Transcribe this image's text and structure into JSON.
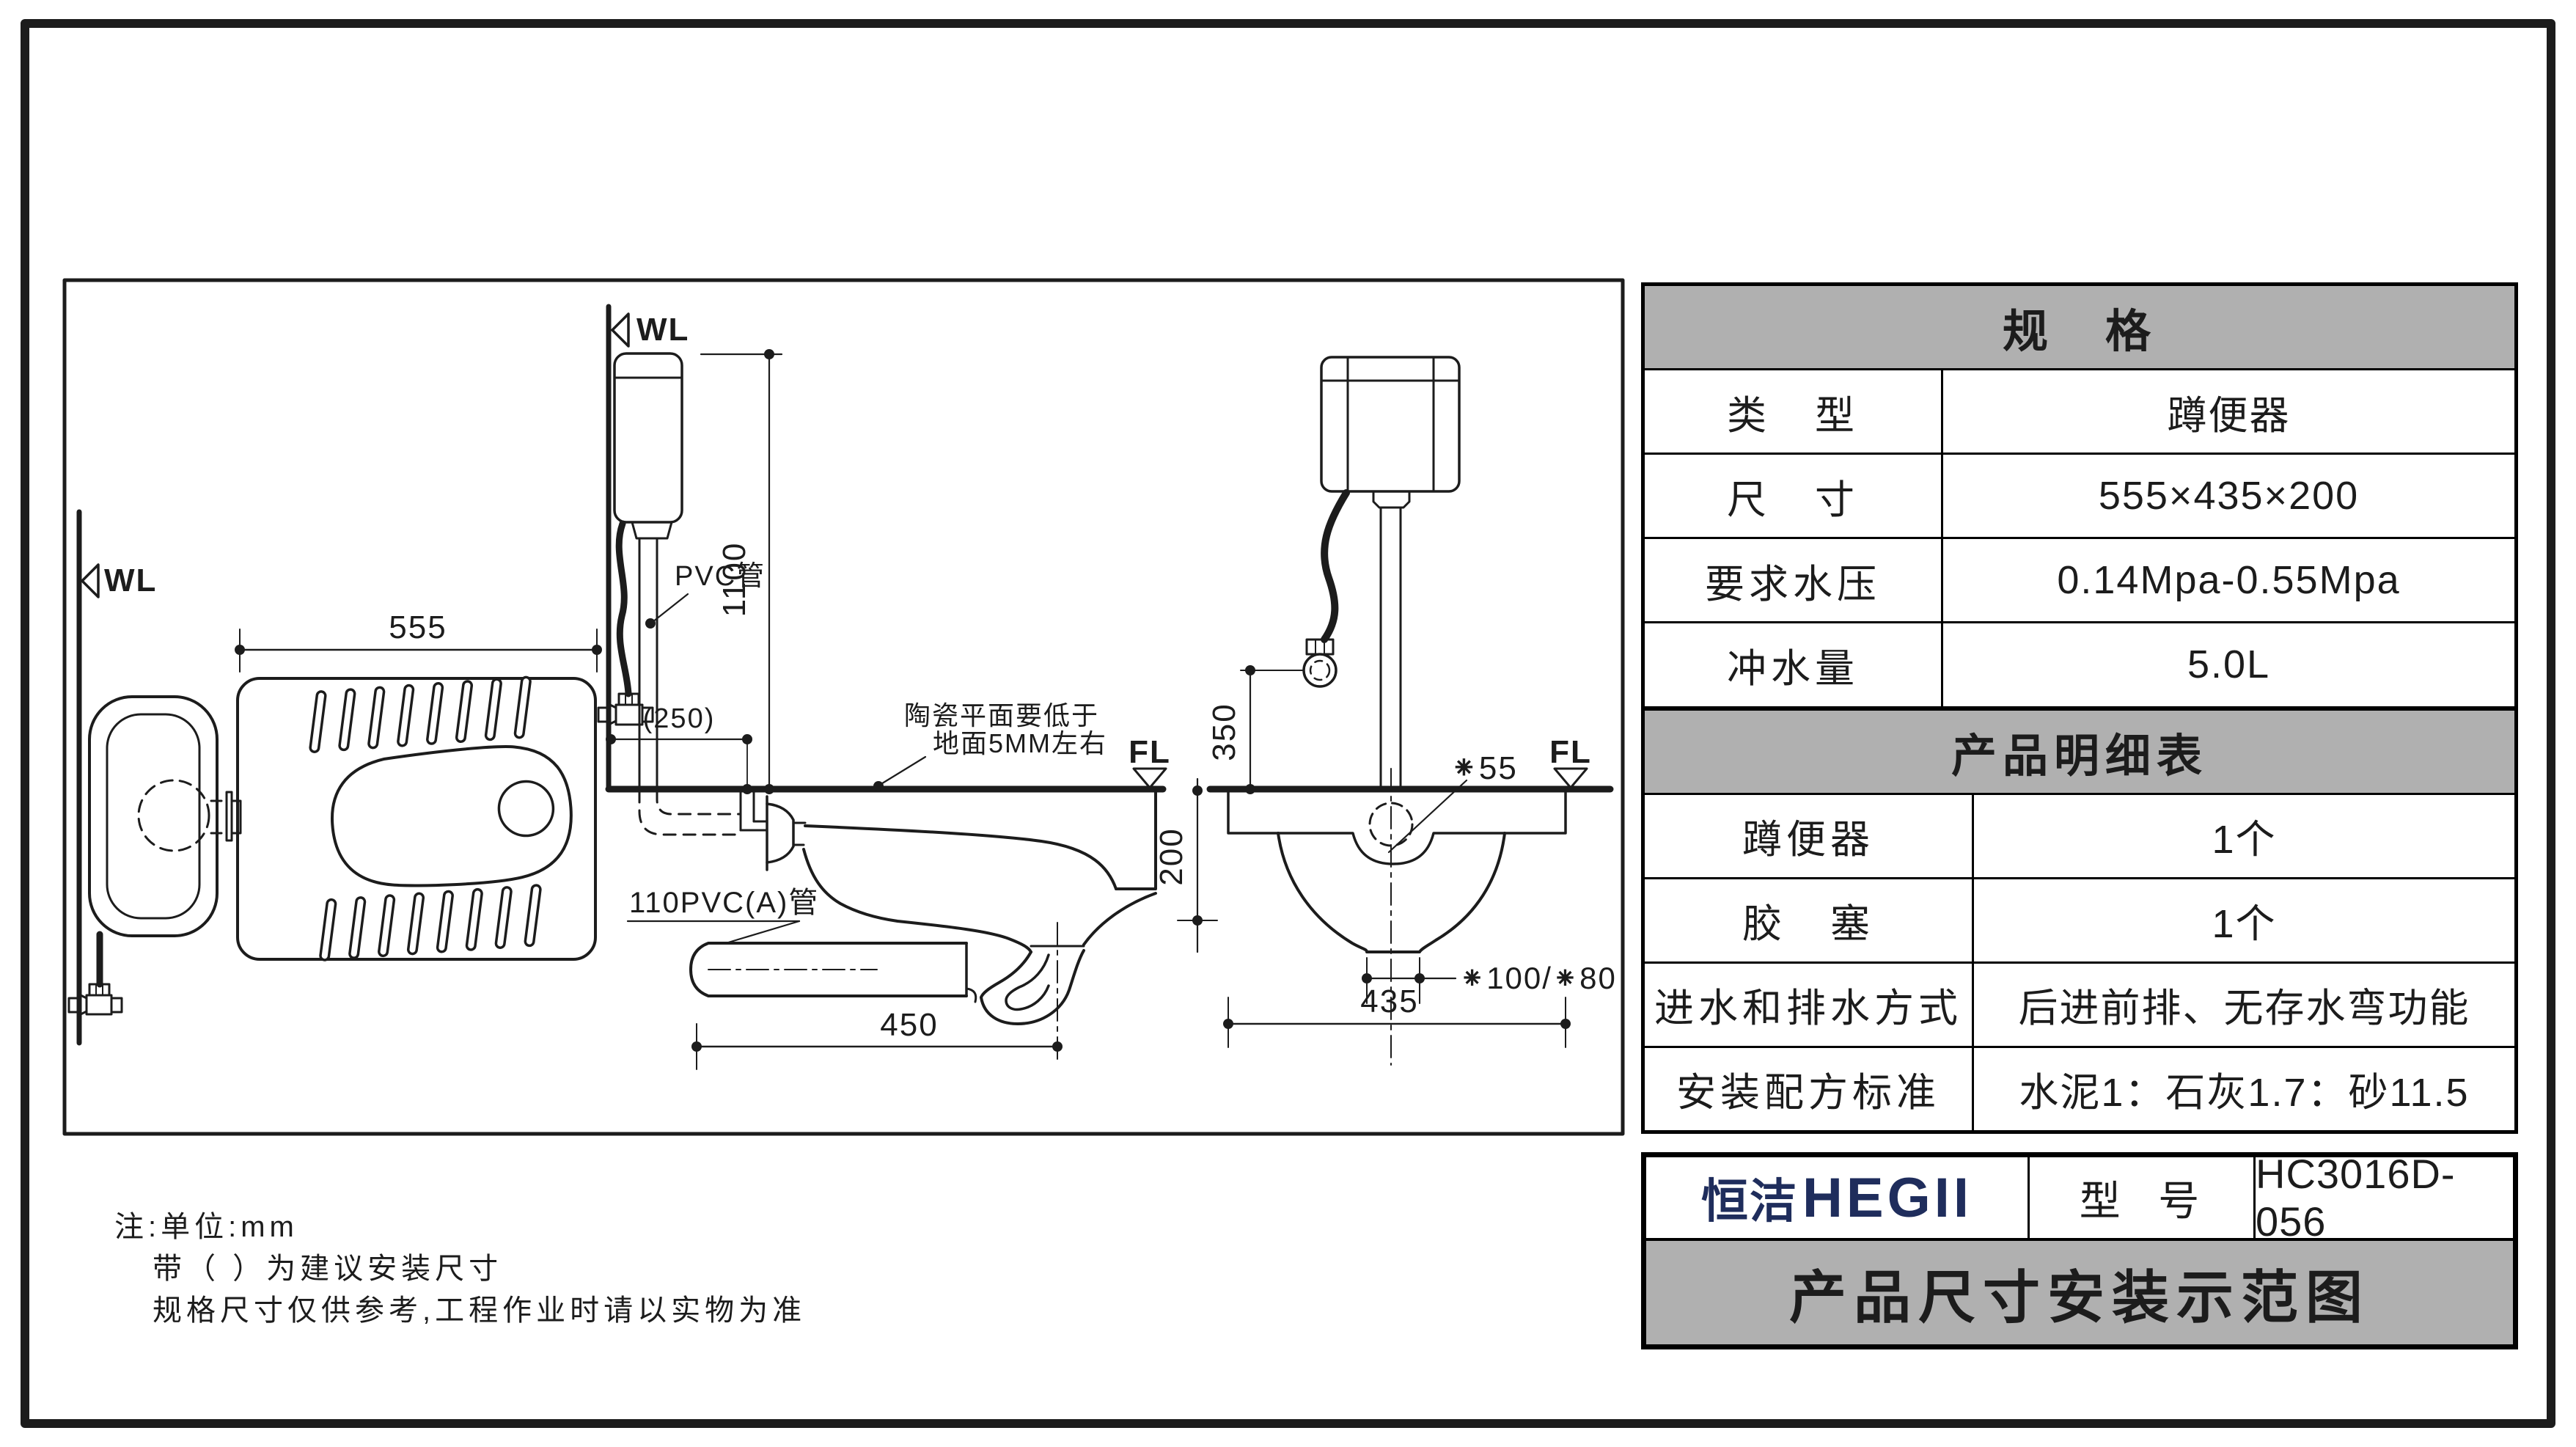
{
  "colors": {
    "line": "#1c1c1c",
    "header_bg": "#b0b0b0",
    "logo_navy": "#1f2d5c",
    "background": "#ffffff"
  },
  "drawing": {
    "markers": {
      "wl": "WL",
      "fl": "FL"
    },
    "dims": {
      "plan_width": "555",
      "cistern_height": "1100",
      "inlet_offset": "(250)",
      "trap_offset": "450",
      "depth": "200",
      "valve_height": "350",
      "pan_width": "435",
      "drain_dia": "⁕55",
      "outlet_dia": "⁕100/⁕80"
    },
    "labels": {
      "pvc_pipe": "PVC管",
      "pvc110_pipe": "110PVC(A)管",
      "ceramic_note_1": "陶瓷平面要低于",
      "ceramic_note_2": "地面5MM左右"
    }
  },
  "spec_table": {
    "title": "规　格",
    "rows": [
      {
        "label": "类　型",
        "value": "蹲便器"
      },
      {
        "label": "尺　寸",
        "value": "555×435×200"
      },
      {
        "label": "要求水压",
        "value": "0.14Mpa-0.55Mpa"
      },
      {
        "label": "冲水量",
        "value": "5.0L"
      }
    ]
  },
  "detail_table": {
    "title": "产品明细表",
    "rows": [
      {
        "label": "蹲便器",
        "value": "1个"
      },
      {
        "label": "胶　塞",
        "value": "1个"
      },
      {
        "label": "进水和排水方式",
        "value": "后进前排、无存水弯功能"
      },
      {
        "label": "安装配方标准",
        "value": "水泥1：石灰1.7：砂11.5"
      }
    ]
  },
  "title_block": {
    "brand_cn": "恒洁",
    "brand_en": "HEGII",
    "model_label": "型 号",
    "model_value": "HC3016D-056",
    "sheet_title": "产品尺寸安装示范图"
  },
  "notes": {
    "line1": "注:单位:mm",
    "line2": "带（ ）为建议安装尺寸",
    "line3": "规格尺寸仅供参考,工程作业时请以实物为准"
  }
}
